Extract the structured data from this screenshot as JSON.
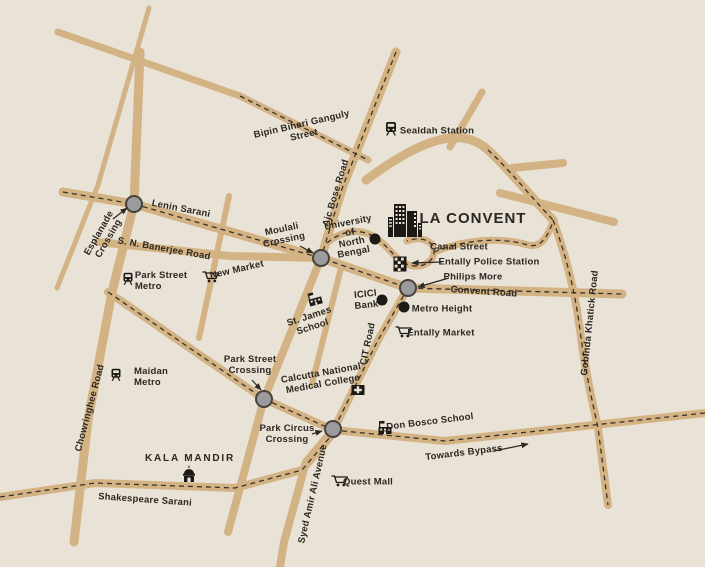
{
  "map": {
    "logo": {
      "name": "LA CONVENT"
    },
    "labels": {
      "bipin_bihari": "Bipin Bihari Ganguly\nStreet",
      "sealdah_station": "Sealdah Station",
      "lenin_sarani": "Lenin Sarani",
      "esplanade_crossing": "Esplanade\nCrossing",
      "sn_banerjee_road": "S. N. Banerjee Road",
      "new_market": "New Market",
      "park_street_metro": "Park Street\nMetro",
      "moulali_crossing": "Moulali\nCrossing",
      "ajc_bose_road": "Ajc Bose Road",
      "university_north_bengal": "University\nof\nNorth\nBengal",
      "canal_street": "Canal Street",
      "entally_police_station": "Entally Police Station",
      "philips_more": "Philips More",
      "convent_road": "Convent Road",
      "icici_bank": "ICICI\nBank",
      "metro_height": "Metro Height",
      "st_james_school": "St. James\nSchool",
      "cit_road": "CIT Road",
      "entally_market": "Entally Market",
      "gobinda_khatick_road": "Gobinda Khatick Road",
      "maidan_metro": "Maidan\nMetro",
      "chowringhee_road": "Chowringhee Road",
      "park_street_crossing": "Park Street\nCrossing",
      "calcutta_national_medical_college": "Calcutta National\nMedical College",
      "park_circus_crossing": "Park Circus\nCrossing",
      "don_bosco_school": "Don Bosco School",
      "towards_bypass": "Towards Bypass",
      "kala_mandir": "KALA MANDIR",
      "quest_mall": "Quest Mall",
      "shakespeare_sarani": "Shakespeare Sarani",
      "syed_amir_ali_avenue": "Syed Amir Ali Avenue"
    },
    "colors": {
      "background": "#e9e2d6",
      "road": "#d3b384",
      "dash": "#3a332b",
      "text": "#2b2722",
      "node_fill": "#9b9b9d",
      "node_stroke": "#46423c",
      "marker": "#1d1a16"
    }
  }
}
